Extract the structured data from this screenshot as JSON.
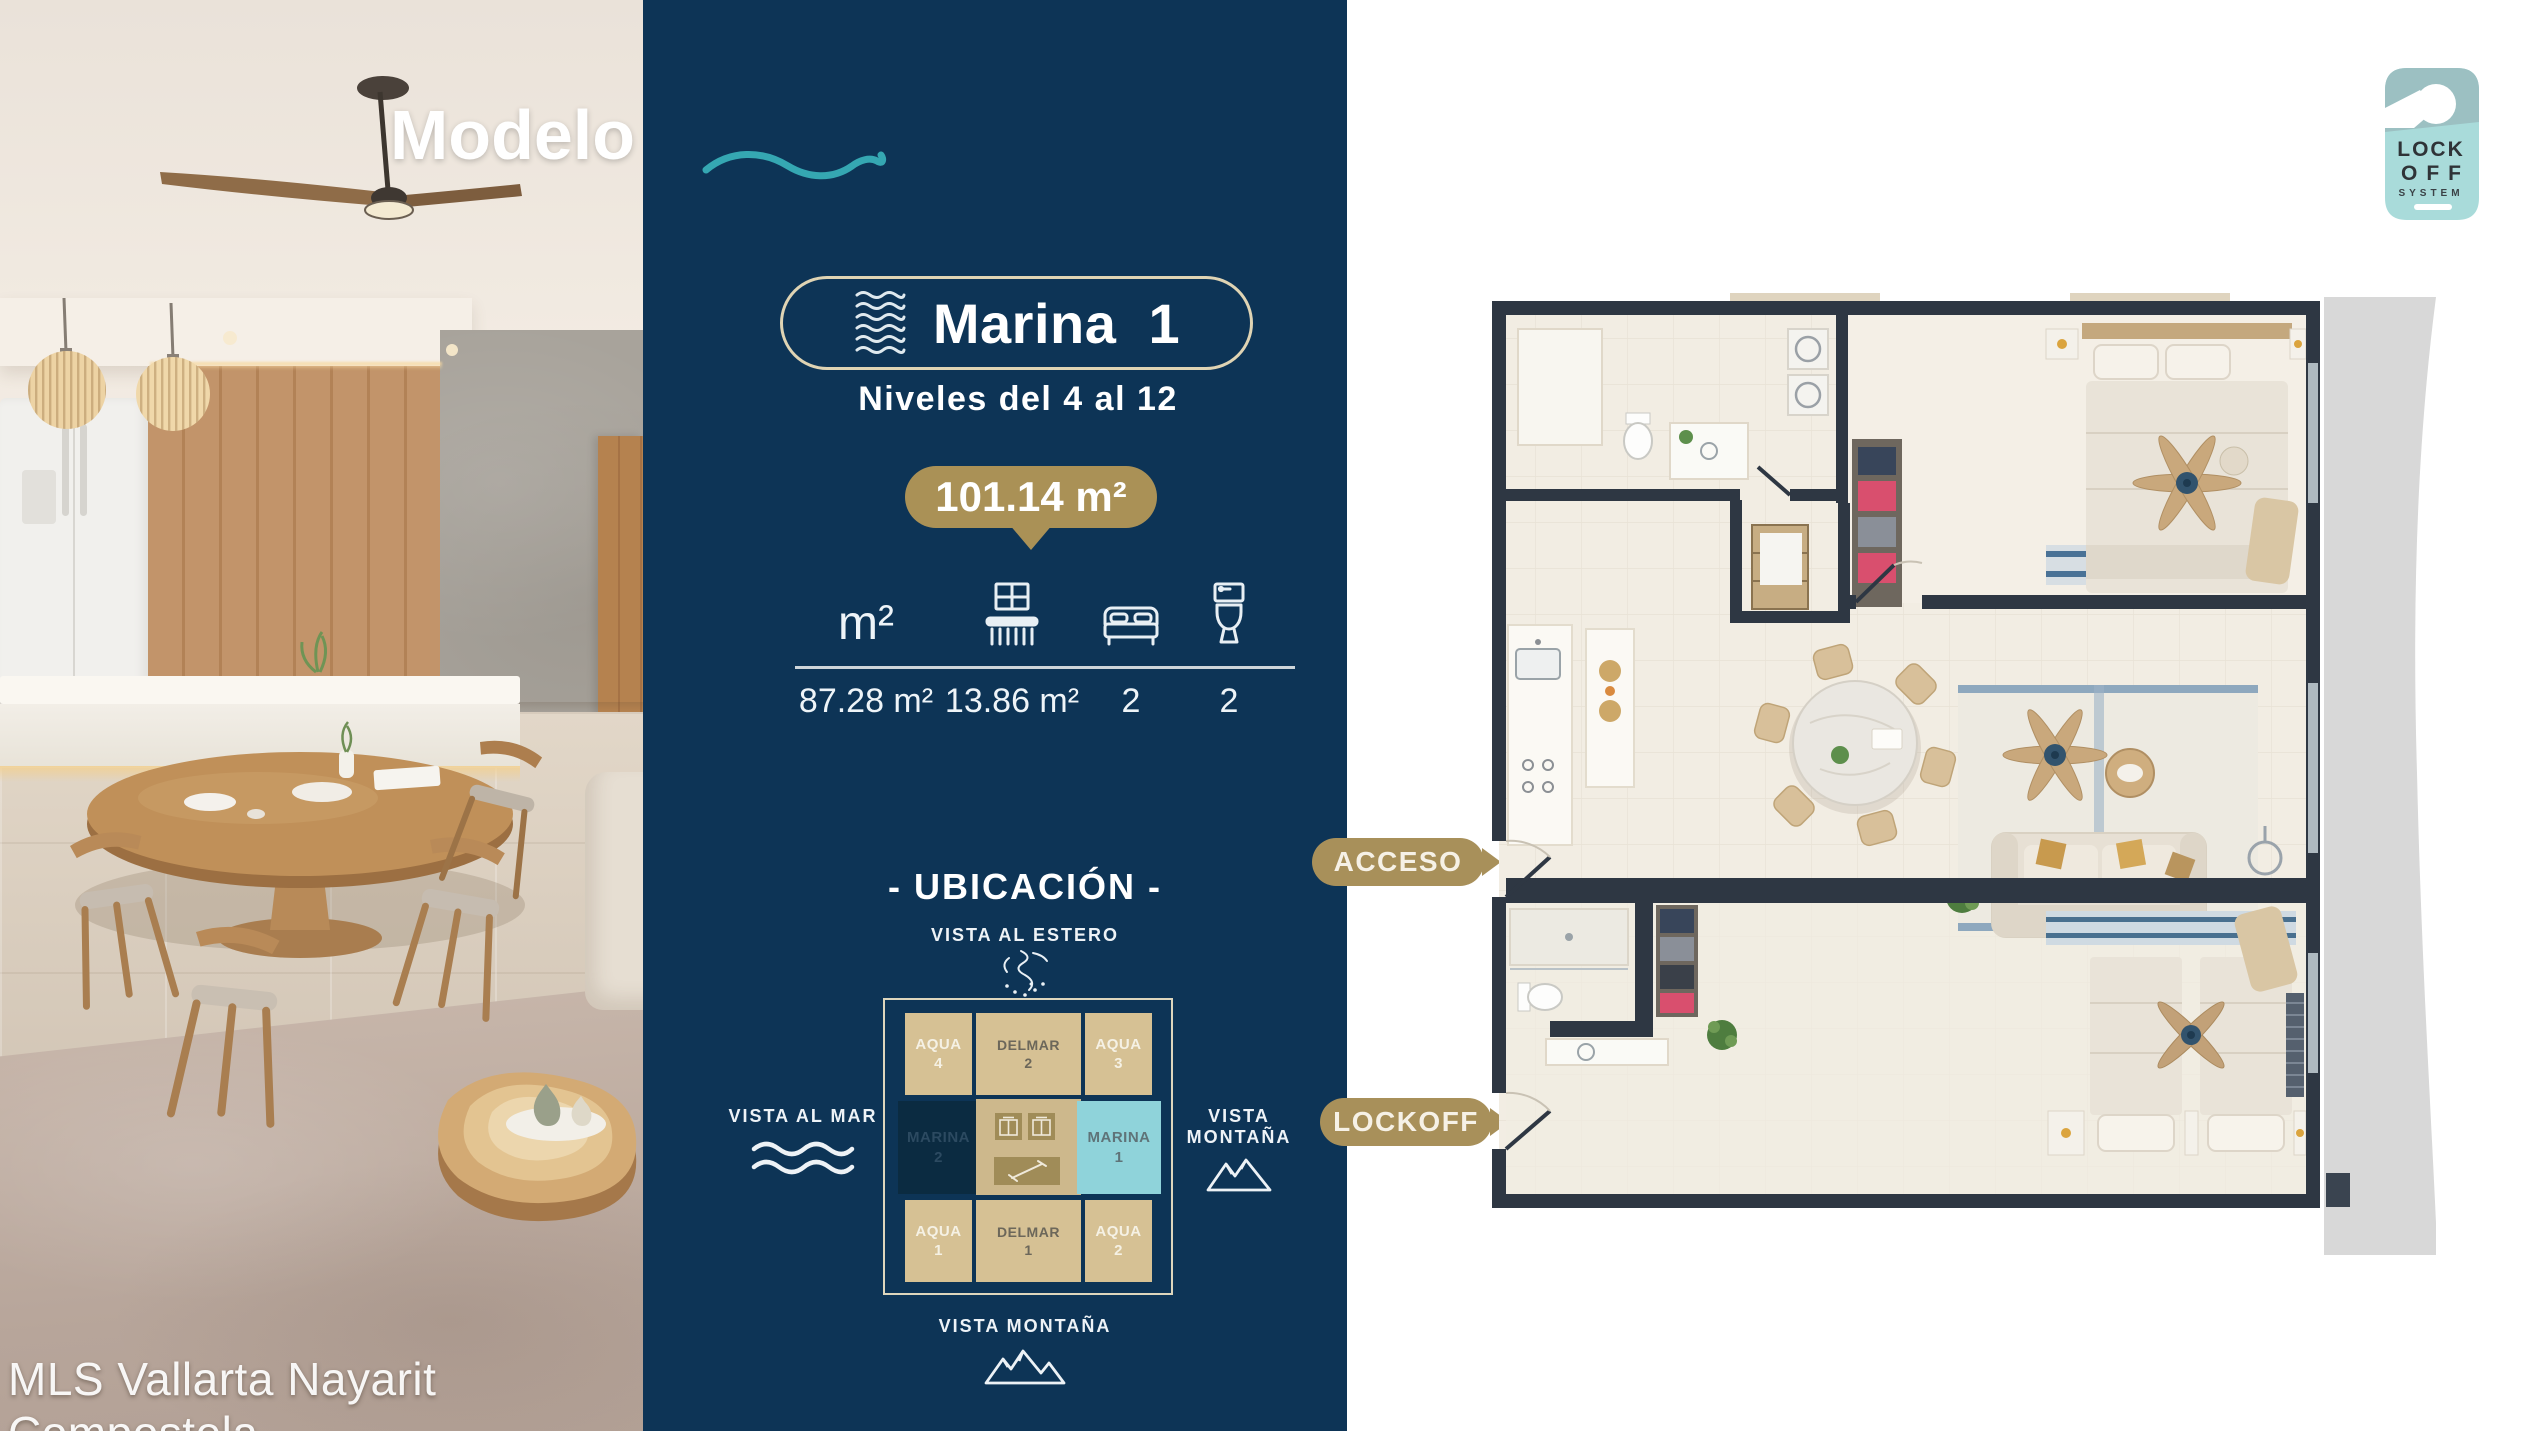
{
  "title": "Modelo Marina",
  "watermark": "MLS Vallarta Nayarit Compostela",
  "logo": {
    "line1": "LOCK",
    "line2": "OFF",
    "line3": "SYSTEM"
  },
  "unit": {
    "name": "Marina 1",
    "levels": "Niveles del 4 al 12",
    "total_area": "101.14 m²",
    "interior_label": "m²",
    "interior_area": "87.28 m²",
    "balcony_area": "13.86 m²",
    "bedrooms": "2",
    "bathrooms": "2"
  },
  "ubicacion": {
    "heading": "- UBICACIÓN -",
    "vista_top": "VISTA AL ESTERO",
    "vista_left": "VISTA AL MAR",
    "vista_right": "VISTA MONTAÑA",
    "vista_bottom": "VISTA MONTAÑA",
    "cells": {
      "aqua4": {
        "name": "AQUA",
        "num": "4"
      },
      "delmar2": {
        "name": "DELMAR",
        "num": "2"
      },
      "aqua3": {
        "name": "AQUA",
        "num": "3"
      },
      "marina2": {
        "name": "MARINA",
        "num": "2"
      },
      "marina1": {
        "name": "MARINA",
        "num": "1"
      },
      "aqua1": {
        "name": "AQUA",
        "num": "1"
      },
      "delmar1": {
        "name": "DELMAR",
        "num": "1"
      },
      "aqua2": {
        "name": "AQUA",
        "num": "2"
      }
    }
  },
  "floorplan": {
    "access_label": "ACCESO",
    "lockoff_label": "LOCKOFF"
  },
  "colors": {
    "navy": "#0d3456",
    "gold": "#a8905a",
    "teal": "#35a7b2",
    "cream_border": "#dfd4b4",
    "cell_tan": "#d6c194",
    "marina1_cyan": "#8fd3da",
    "marina2_navy": "#0b2b41",
    "wall": "#2e3743"
  }
}
